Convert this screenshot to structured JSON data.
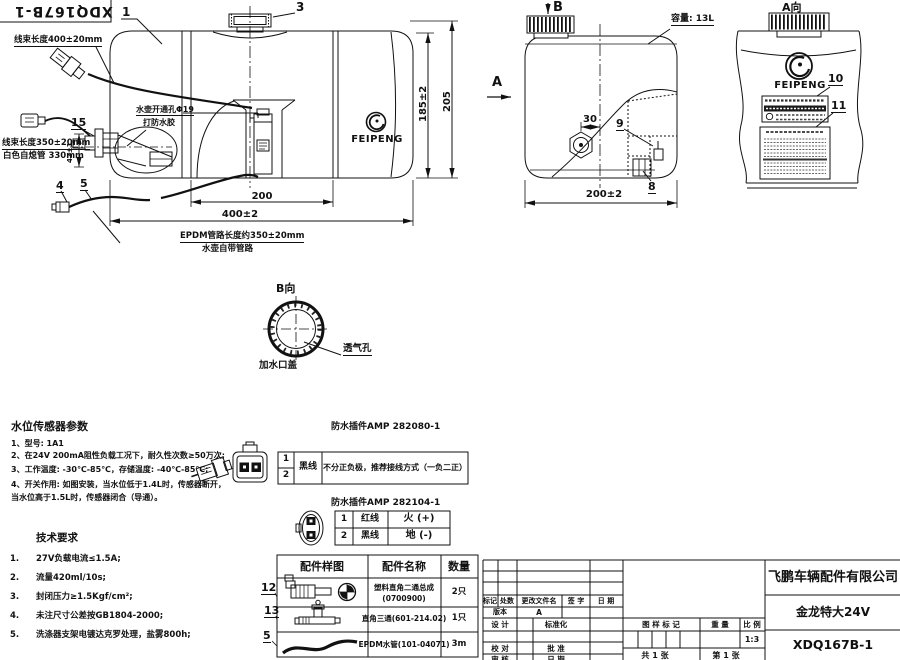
{
  "corner": {
    "drawing_no": "XDQ167B-1",
    "balloon_1": "1"
  },
  "front_view": {
    "balloon_3": "3",
    "balloon_15": "15",
    "balloon_4": "4",
    "balloon_5": "5",
    "label_harness_top": "线束长度400±20mm",
    "label_harness_left1": "线束长度350±20mm",
    "label_harness_left2": "白色自熄管 330mm",
    "label_hole": "水壶开通孔Φ19",
    "label_glue": "打防水胶",
    "dim_42": "42±1",
    "dim_200": "200",
    "dim_400": "400±2",
    "dim_185": "185±2",
    "dim_205": "205",
    "note_epdm": "EPDM管路长度约350±20mm",
    "note_pipe": "水壶自带管路",
    "logo": "FEIPENG"
  },
  "side_view": {
    "view_b": "B",
    "view_a": "A",
    "capacity": "容量: 13L",
    "dim_30": "30",
    "balloon_9": "9",
    "balloon_8": "8",
    "dim_200": "200±2"
  },
  "a_view": {
    "title": "A向",
    "logo": "FEIPENG",
    "balloon_10": "10",
    "balloon_11": "11"
  },
  "b_view": {
    "title": "B向",
    "vent": "透气孔",
    "cap": "加水口盖"
  },
  "sensor_params": {
    "title": "水位传感器参数",
    "lines": [
      "1、型号: 1A1",
      "2、在24V 200mA阻性负载工况下，耐久性次数≥50万次;",
      "3、工作温度: -30℃-85℃，存储温度: -40℃-85℃;",
      "4、开关作用: 如图安装，当水位低于1.4L时，传感器断开，",
      "当水位高于1.5L时，传感器闭合（导通）。"
    ]
  },
  "tech_req": {
    "title": "技术要求",
    "items": [
      {
        "no": "1.",
        "text": "27V负载电流≤1.5A;"
      },
      {
        "no": "2.",
        "text": "流量420ml/10s;"
      },
      {
        "no": "3.",
        "text": "封闭压力≥1.5Kgf/cm²;"
      },
      {
        "no": "4.",
        "text": "未注尺寸公差按GB1804-2000;"
      },
      {
        "no": "5.",
        "text": "洗涤器支架电镀达克罗处理，盐雾800h;"
      }
    ]
  },
  "connector1": {
    "title": "防水插件AMP 282080-1",
    "pin1": "1",
    "pin2": "2",
    "wire": "黑线",
    "desc": "不分正负极，推荐接线方式（一负二正）"
  },
  "connector2": {
    "title": "防水插件AMP 282104-1",
    "rows": [
      {
        "pin": "1",
        "wire": "红线",
        "desc": "火 (+)"
      },
      {
        "pin": "2",
        "wire": "黑线",
        "desc": "地 (-)"
      }
    ]
  },
  "parts_table": {
    "col_sample": "配件样图",
    "col_name": "配件名称",
    "col_qty": "数量",
    "rows": [
      {
        "balloon": "12",
        "name": "塑料直角二通总成",
        "name2": "(0700900)",
        "qty": "2只"
      },
      {
        "balloon": "13",
        "name": "直角三通(601-214.02)",
        "name2": "",
        "qty": "1只"
      },
      {
        "balloon": "5",
        "name": "EPDM水管(101-04071)",
        "name2": "",
        "qty": "3m"
      }
    ]
  },
  "title_block": {
    "company": "飞鹏车辆配件有限公司",
    "product": "金龙特大24V",
    "drawing_no": "XDQ167B-1",
    "col_mark": "标记",
    "col_count": "处数",
    "col_file": "更改文件名",
    "col_sign": "签 字",
    "col_date": "日 期",
    "version_label": "版本",
    "version": "A",
    "design": "设 计",
    "standardize": "标准化",
    "check": "校 对",
    "approve": "批 准",
    "review": "审 核",
    "date2": "日 期",
    "mark": "图 样 标 记",
    "weight": "重 量",
    "scale": "比 例",
    "scale_val": "1:3",
    "sheet_total": "共 1 张",
    "sheet_num": "第 1 张"
  }
}
